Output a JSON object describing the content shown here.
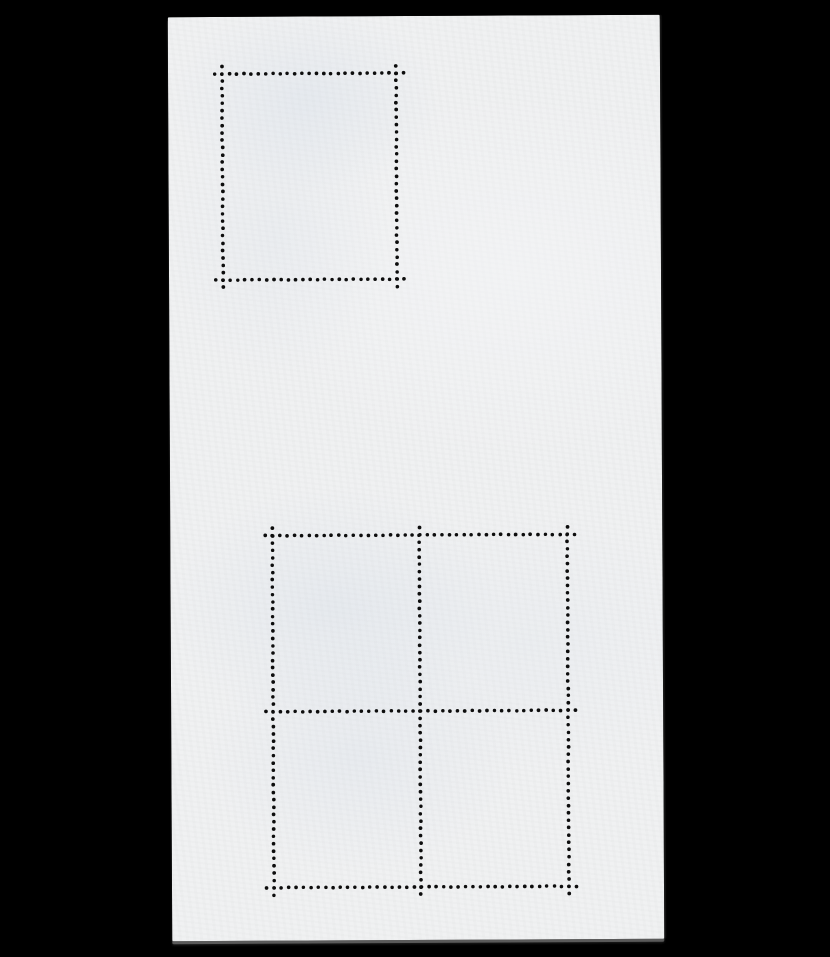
{
  "scene": {
    "type": "photograph",
    "subject": "blank stamp souvenir sheet reverse side with perforation holes",
    "background_color": "#000000"
  },
  "paper": {
    "left": 170,
    "top": 16,
    "width": 492,
    "height": 924,
    "rotation_deg": -0.28,
    "color": "#f0f1f2",
    "mottle_tint": "#dfe6f0",
    "edge_shadow_color": "#969696"
  },
  "perforation": {
    "hole_color": "#0d0d0d",
    "dot_radius": 1.8,
    "dot_spacing": 7.4,
    "overrun_holes": 1,
    "blocks": [
      {
        "name": "single-stamp-outline",
        "rows": 1,
        "cols": 1,
        "xs": [
          54,
          228
        ],
        "ys": [
          57,
          263
        ]
      },
      {
        "name": "quad-stamp-block-outline",
        "rows": 2,
        "cols": 2,
        "xs": [
          102,
          249,
          397
        ],
        "ys": [
          519,
          695,
          871
        ]
      }
    ]
  }
}
